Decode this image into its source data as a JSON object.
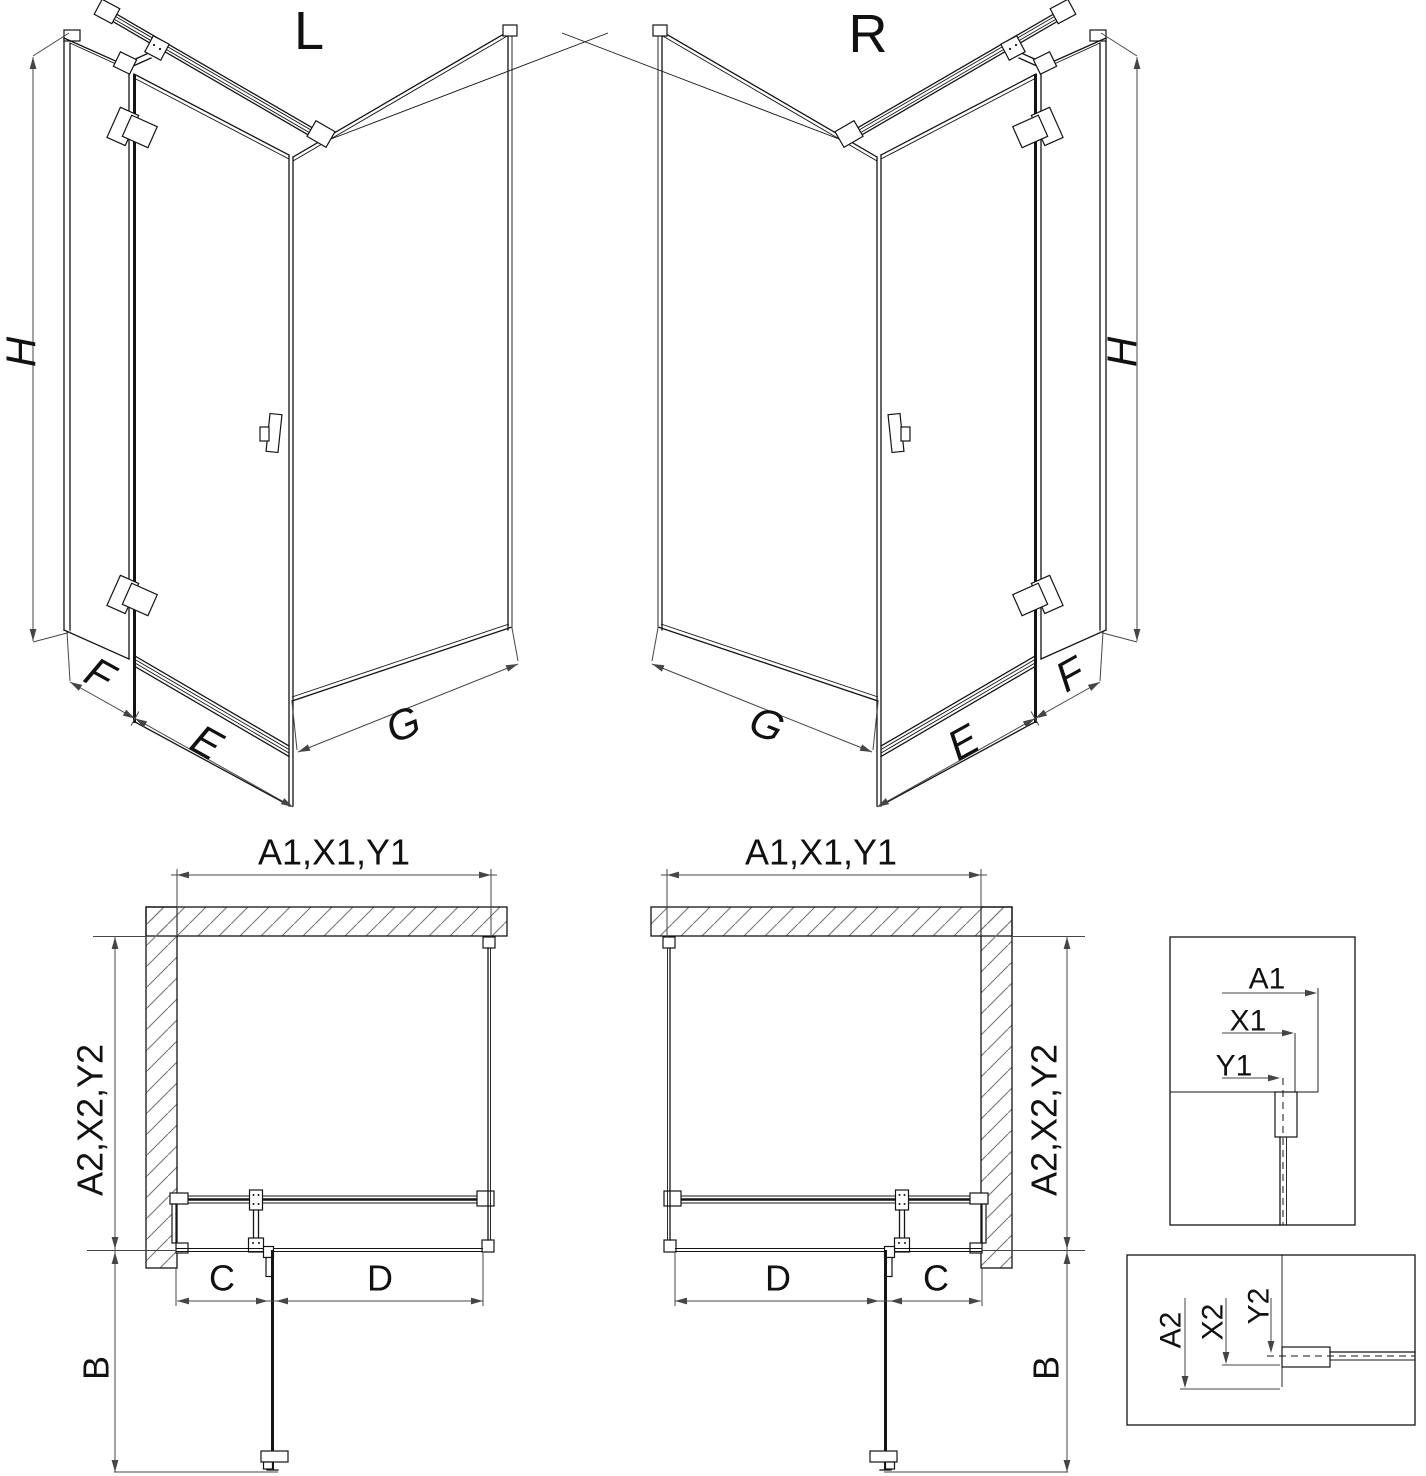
{
  "drawing": {
    "type": "shower-enclosure-technical-drawing",
    "colors": {
      "line": "#141414",
      "dimension": "#454545",
      "hatch": "#777777",
      "background": "#ffffff"
    },
    "iso_views": [
      {
        "label": "L",
        "dim_height": "H",
        "dim_fixed_panel": "F",
        "dim_door": "E",
        "dim_side_panel": "G"
      },
      {
        "label": "R",
        "dim_height": "H",
        "dim_fixed_panel": "F",
        "dim_door": "E",
        "dim_side_panel": "G"
      }
    ],
    "plan_views": [
      {
        "dim_width_top": "A1,X1,Y1",
        "dim_depth_side": "A2,X2,Y2",
        "dim_door_segment": "C",
        "dim_fixed_segment": "D",
        "dim_door_open": "B"
      },
      {
        "dim_width_top": "A1,X1,Y1",
        "dim_depth_side": "A2,X2,Y2",
        "dim_door_segment": "C",
        "dim_fixed_segment": "D",
        "dim_door_open": "B"
      }
    ],
    "detail_views": [
      {
        "dim_a": "A1",
        "dim_x": "X1",
        "dim_y": "Y1"
      },
      {
        "dim_a": "A2",
        "dim_x": "X2",
        "dim_y": "Y2"
      }
    ]
  }
}
